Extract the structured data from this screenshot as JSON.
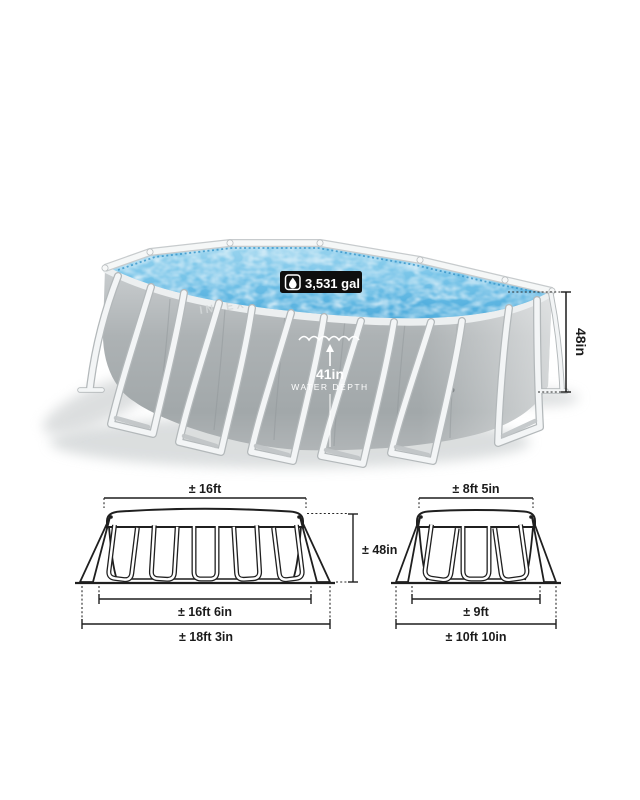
{
  "brand": "INTEX",
  "pool": {
    "capacity": "3,531 gal",
    "water_depth_value": "41in",
    "water_depth_label": "WATER DEPTH",
    "height": "48in"
  },
  "diagrams": {
    "side_view": {
      "top_width": "± 16ft",
      "height": "± 48in",
      "base_width": "± 16ft 6in",
      "footprint_width": "± 18ft 3in"
    },
    "end_view": {
      "top_width": "± 8ft 5in",
      "base_width": "± 9ft",
      "footprint_width": "± 10ft 10in"
    }
  },
  "icons": {
    "capacity_icon": "water-drop-icon"
  },
  "colors": {
    "water": "#55b1e0",
    "water_light": "#b3dff3",
    "wall_gray": "#aab0b2",
    "frame_white": "#f3f5f6",
    "badge_bg": "#0e0e0e",
    "text_dark": "#1b1b1b"
  }
}
